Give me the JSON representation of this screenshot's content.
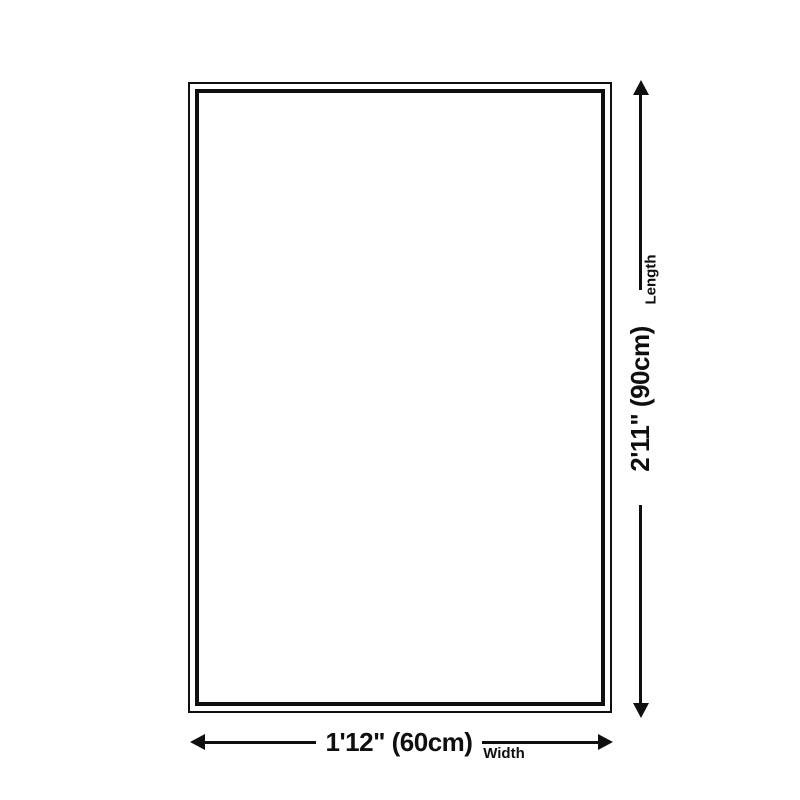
{
  "diagram": {
    "type": "product-dimensions",
    "colors": {
      "line": "#0f0f0f",
      "background": "#ffffff"
    },
    "width_dimension": {
      "value": "1'12\" (60cm)",
      "axis_label": "Width"
    },
    "length_dimension": {
      "value": "2'11\" (90cm)",
      "axis_label": "Length"
    }
  }
}
